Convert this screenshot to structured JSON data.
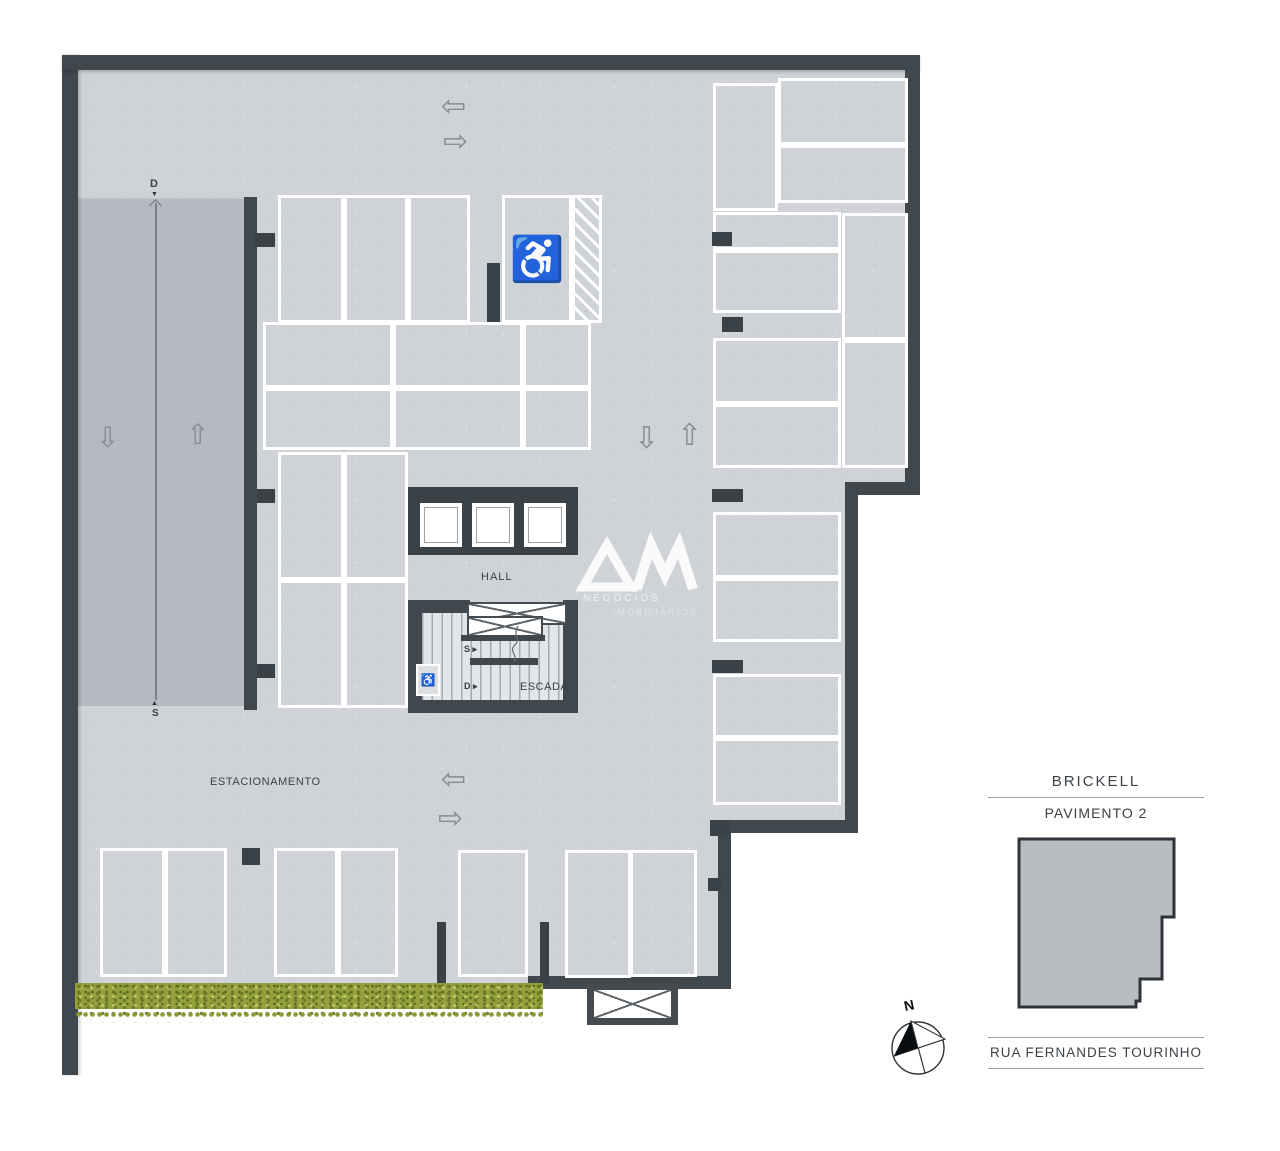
{
  "labels": {
    "hall": "HALL",
    "escada": "ESCADA",
    "estacionamento": "ESTACIONAMENTO",
    "ramp_top_marker": "D",
    "ramp_bottom_marker": "S",
    "stair_up_marker": "S",
    "stair_down_marker": "D",
    "up_triangle": "▲",
    "down_triangle": "▼",
    "right_triangle": "�serialize"
  },
  "markers": {
    "stair_up": "S ▸",
    "stair_down": "D ▸"
  },
  "logo": {
    "monogram": "AM",
    "line1": "NEGÓCIOS",
    "line2": "IMOBILIÁRIOS"
  },
  "panel": {
    "building": "BRICKELL",
    "floor": "PAVIMENTO 2",
    "street": "RUA FERNANDES TOURINHO"
  },
  "compass": {
    "north": "N"
  },
  "icons": {
    "wheelchair": "♿"
  },
  "colors": {
    "wall": "#40474d",
    "floor": "#cfd3d7",
    "ramp": "#b5bac0",
    "stripe": "#ffffff",
    "grass": "#93a03c",
    "text": "#3b4146",
    "arrow": "#878d92",
    "miniplan_fill": "#b9bdc0"
  },
  "plan": {
    "spots": [
      [
        278,
        195,
        66,
        128,
        "p"
      ],
      [
        344,
        195,
        64,
        128,
        "p"
      ],
      [
        408,
        195,
        62,
        128,
        "p"
      ],
      [
        502,
        195,
        70,
        128,
        "a"
      ],
      [
        572,
        195,
        30,
        128,
        "h"
      ],
      [
        263,
        322,
        130,
        66,
        "p"
      ],
      [
        393,
        322,
        130,
        66,
        "p"
      ],
      [
        263,
        388,
        130,
        62,
        "p"
      ],
      [
        393,
        388,
        130,
        62,
        "p"
      ],
      [
        523,
        322,
        68,
        66,
        "p"
      ],
      [
        523,
        388,
        68,
        62,
        "p"
      ],
      [
        278,
        452,
        66,
        128,
        "p"
      ],
      [
        344,
        452,
        64,
        128,
        "p"
      ],
      [
        278,
        580,
        66,
        128,
        "p"
      ],
      [
        344,
        580,
        64,
        128,
        "p"
      ],
      [
        713,
        83,
        65,
        128,
        "p"
      ],
      [
        778,
        78,
        130,
        67,
        "p"
      ],
      [
        778,
        145,
        130,
        58,
        "p"
      ],
      [
        713,
        212,
        128,
        38,
        "p"
      ],
      [
        713,
        250,
        128,
        63,
        "p"
      ],
      [
        713,
        338,
        128,
        66,
        "p"
      ],
      [
        713,
        404,
        128,
        64,
        "p"
      ],
      [
        842,
        213,
        66,
        127,
        "p"
      ],
      [
        842,
        340,
        66,
        128,
        "p"
      ],
      [
        713,
        512,
        128,
        66,
        "p"
      ],
      [
        713,
        578,
        128,
        64,
        "p"
      ],
      [
        713,
        674,
        128,
        64,
        "p"
      ],
      [
        713,
        738,
        128,
        67,
        "p"
      ],
      [
        100,
        848,
        65,
        129,
        "p"
      ],
      [
        165,
        848,
        62,
        129,
        "p"
      ],
      [
        274,
        848,
        64,
        129,
        "p"
      ],
      [
        338,
        848,
        60,
        129,
        "p"
      ],
      [
        458,
        850,
        70,
        127,
        "p"
      ],
      [
        565,
        850,
        66,
        128,
        "p"
      ],
      [
        630,
        850,
        67,
        127,
        "p"
      ]
    ],
    "pillars": [
      [
        255,
        233,
        20,
        14
      ],
      [
        257,
        489,
        18,
        14
      ],
      [
        257,
        664,
        18,
        14
      ],
      [
        487,
        263,
        13,
        59
      ],
      [
        712,
        232,
        20,
        14
      ],
      [
        722,
        317,
        21,
        15
      ],
      [
        712,
        489,
        31,
        13
      ],
      [
        712,
        660,
        31,
        13
      ],
      [
        710,
        820,
        20,
        16
      ],
      [
        242,
        848,
        18,
        17
      ],
      [
        437,
        922,
        9,
        76
      ],
      [
        540,
        922,
        9,
        62
      ],
      [
        708,
        878,
        14,
        13
      ]
    ],
    "arrows": [
      {
        "g": "⇦",
        "x": 441,
        "y": 92,
        "s": 30
      },
      {
        "g": "⇨",
        "x": 443,
        "y": 127,
        "s": 30
      },
      {
        "g": "⇩",
        "x": 634,
        "y": 424,
        "s": 30
      },
      {
        "g": "⇧",
        "x": 677,
        "y": 421,
        "s": 30
      },
      {
        "g": "⇦",
        "x": 441,
        "y": 765,
        "s": 30
      },
      {
        "g": "⇨",
        "x": 438,
        "y": 804,
        "s": 30
      },
      {
        "g": "⇩",
        "x": 96,
        "y": 424,
        "s": 28
      },
      {
        "g": "⇧",
        "x": 186,
        "y": 421,
        "s": 28
      }
    ]
  }
}
